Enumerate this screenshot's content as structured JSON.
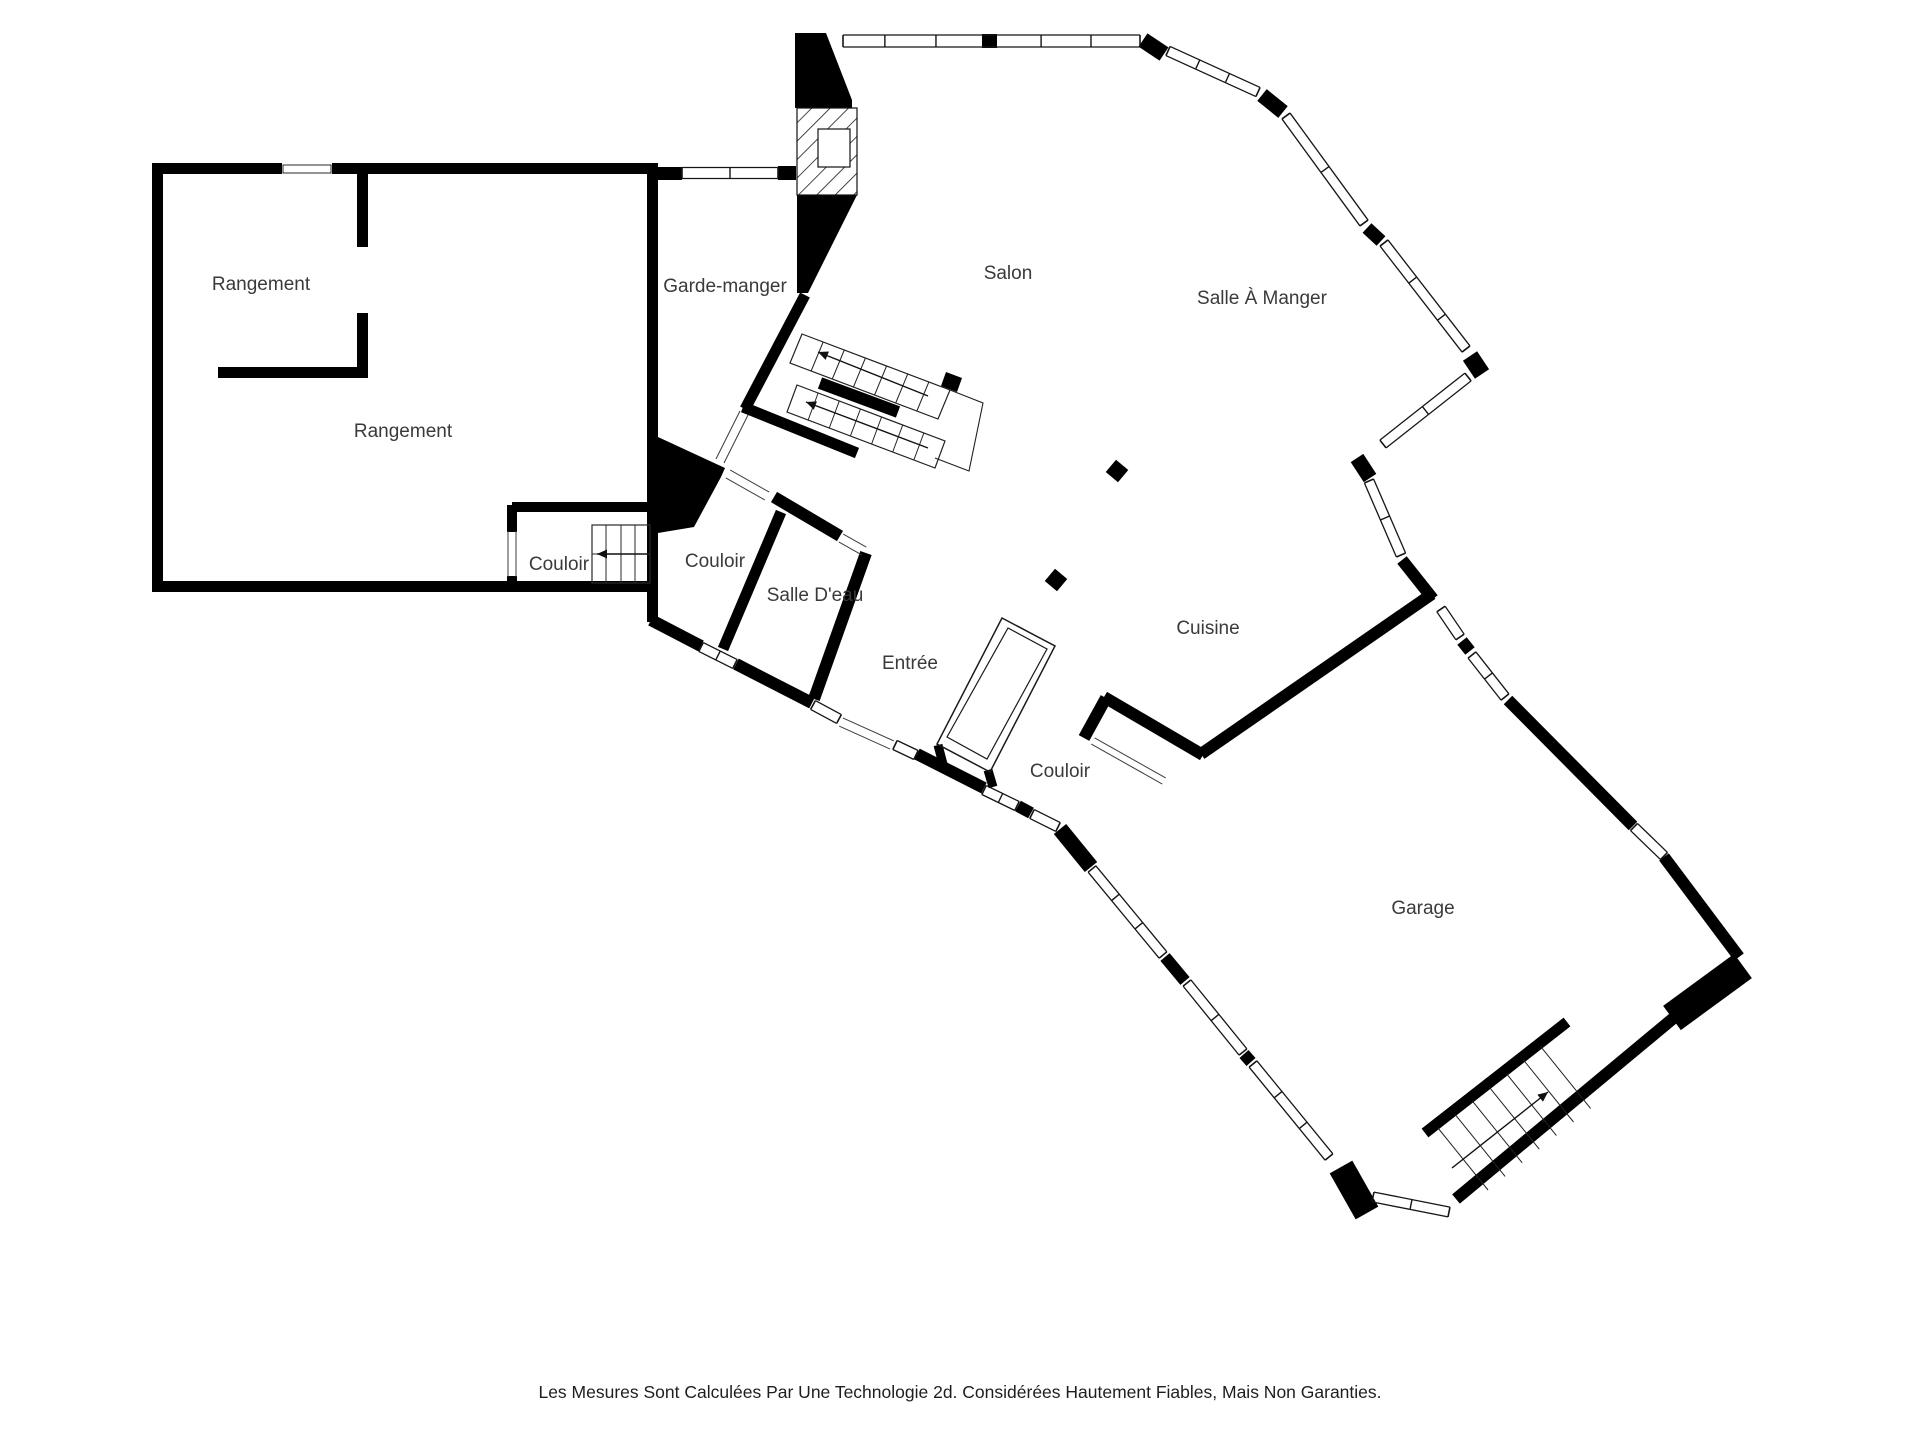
{
  "title": "Plan d'étage",
  "rooms": {
    "rangement_upper": "Rangement",
    "rangement_lower": "Rangement",
    "couloir_storage": "Couloir",
    "garde_manger": "Garde-manger",
    "salon": "Salon",
    "salle_a_manger": "Salle À Manger",
    "couloir_hall": "Couloir",
    "salle_deau": "Salle D'eau",
    "entree": "Entrée",
    "cuisine": "Cuisine",
    "couloir_garage": "Couloir",
    "garage": "Garage"
  },
  "footer": {
    "disclaimer": "Les Mesures Sont Calculées Par Une Technologie 2d. Considérées Hautement Fiables, Mais Non Garanties."
  },
  "colors": {
    "wall": "#000000",
    "label": "#3a3a3a",
    "background": "#ffffff"
  }
}
